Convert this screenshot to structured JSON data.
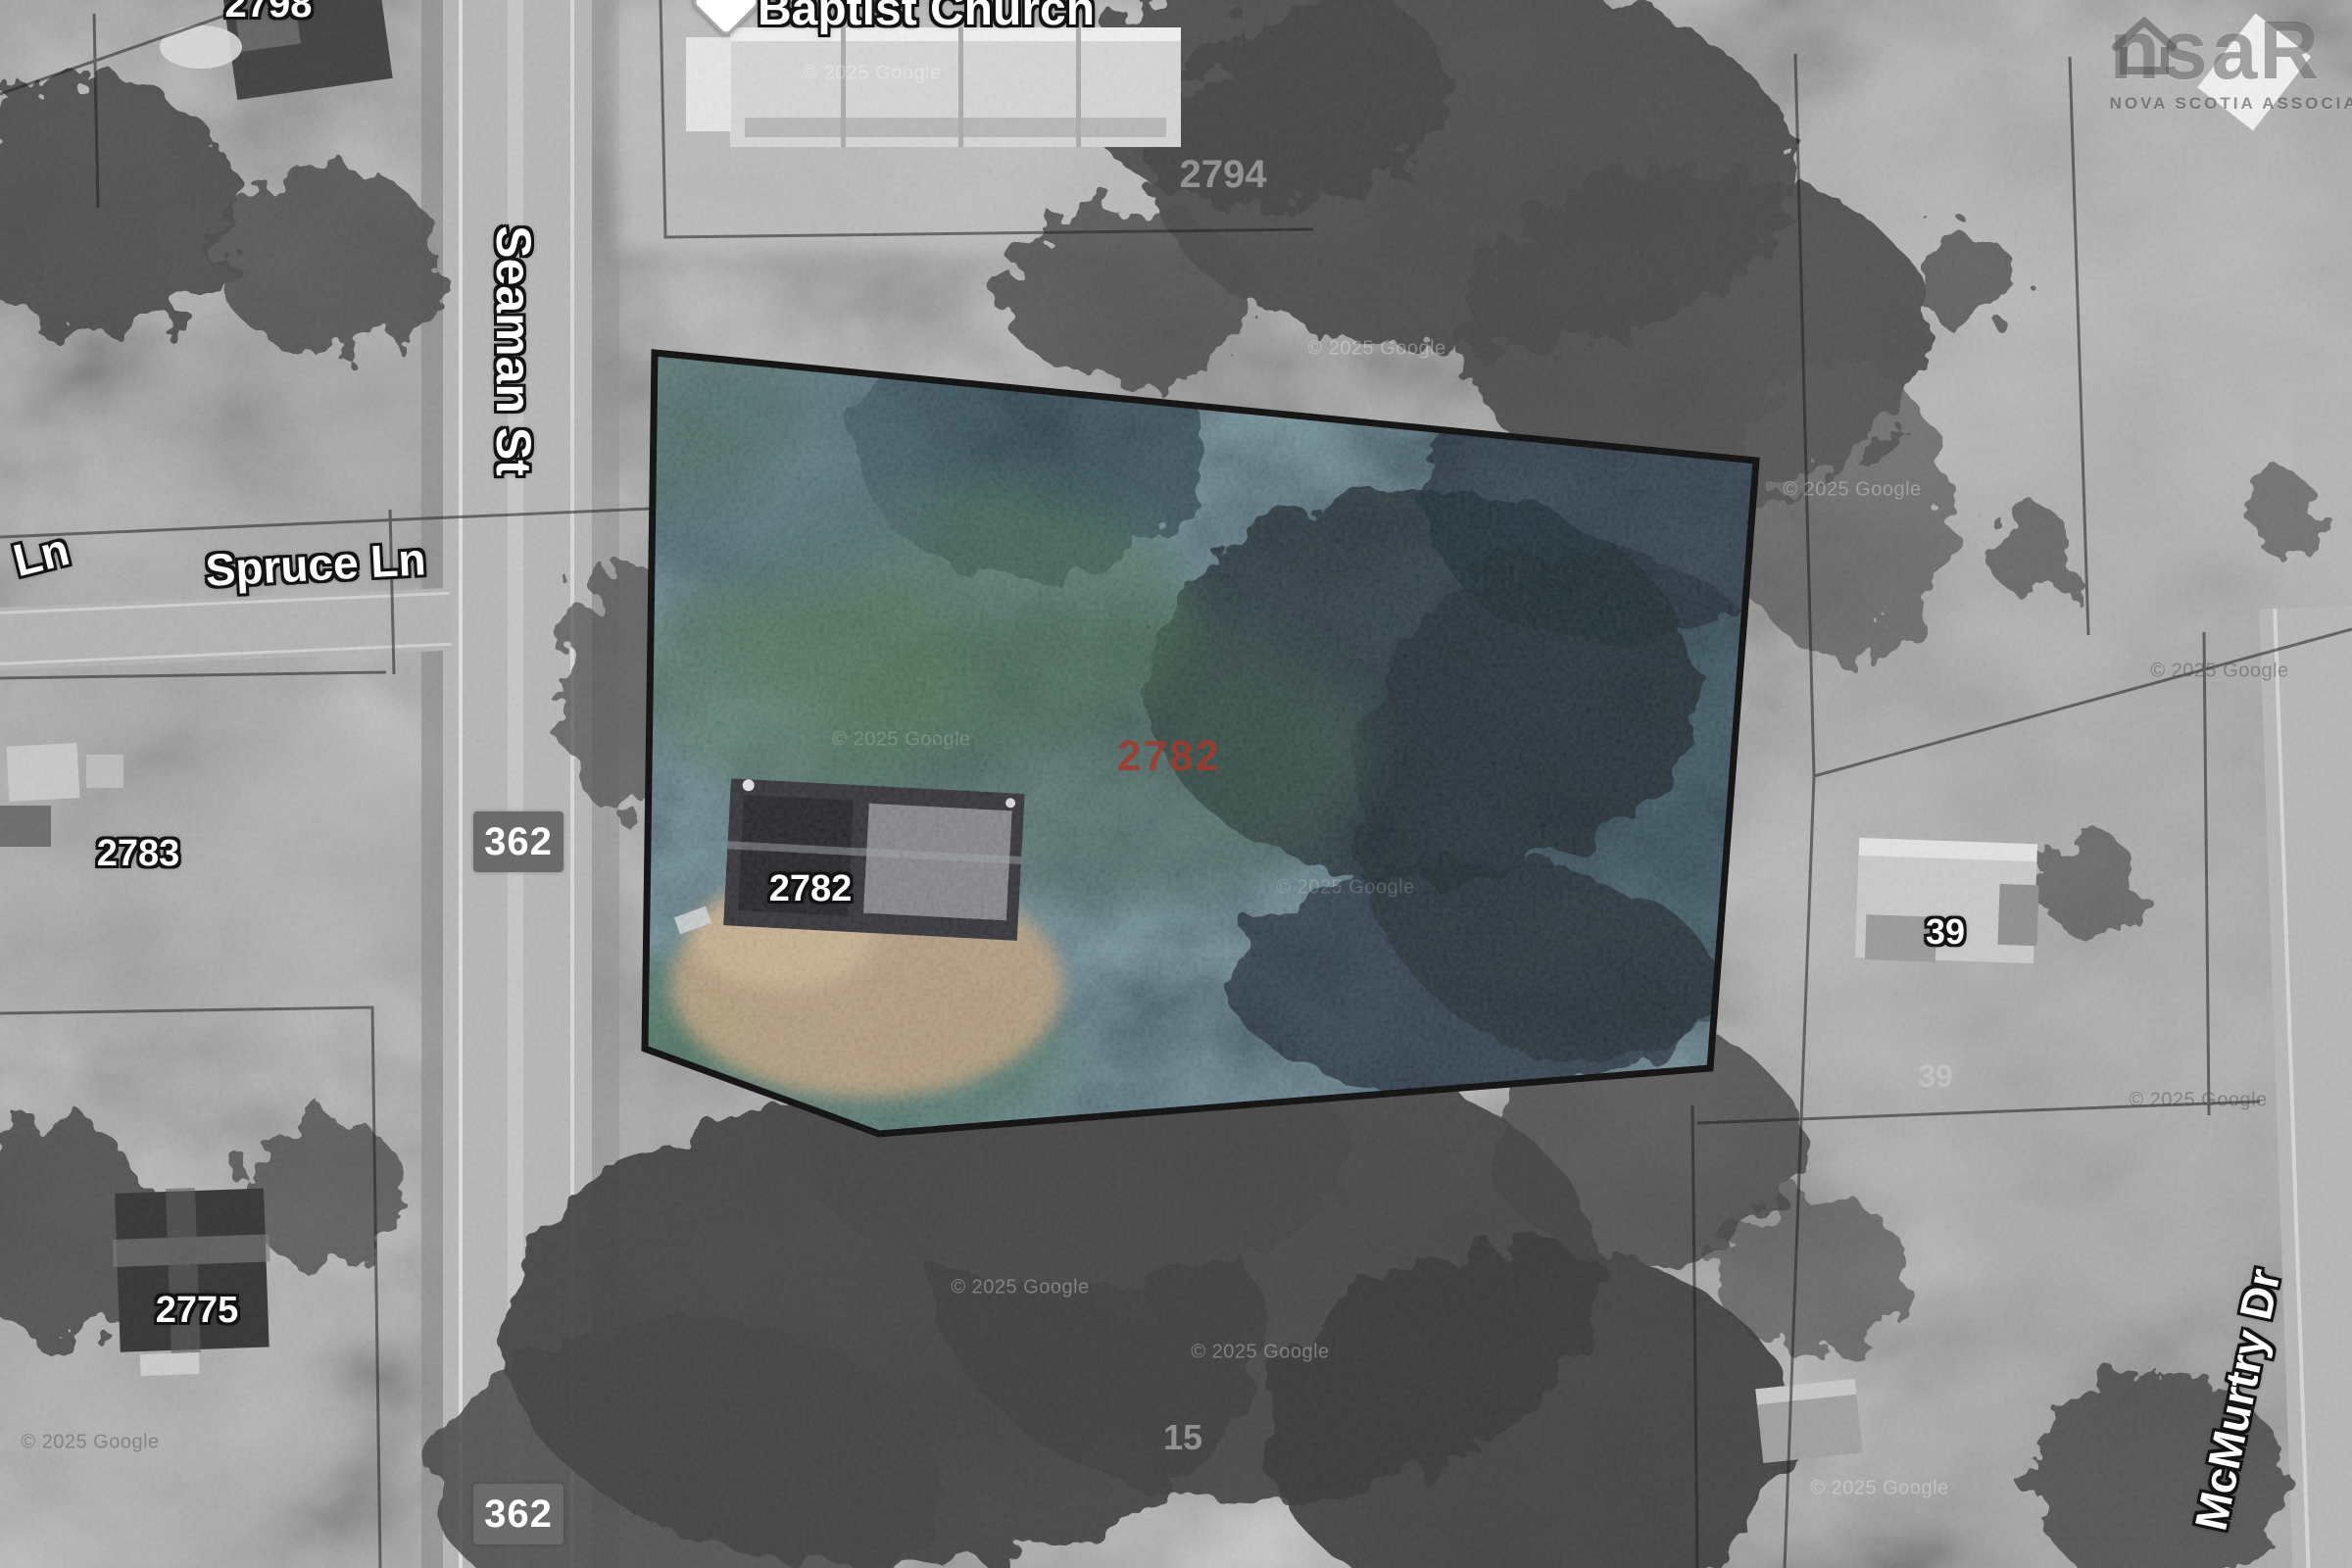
{
  "map": {
    "attribution": "© 2025 Google",
    "poi_baptist_church": "Baptist Church",
    "street_seaman": "Seaman St",
    "street_spruce": "Spruce Ln",
    "street_ln_partial": "Ln",
    "street_mcmurtry": "McMurtry Dr",
    "route_shield": "362",
    "parcel_number": "2782",
    "parcel_number_color": "#a23a2e",
    "parcel_outline_color": "#0a0a0a",
    "house_2798": "2798",
    "house_2783": "2783",
    "house_2775": "2775",
    "house_2782": "2782",
    "house_39": "39",
    "lot_2794": "2794",
    "lot_39": "39",
    "lot_15": "15",
    "branding_prefix": "ns",
    "branding_suffix": "aR",
    "branding_subtext": "NOVA SCOTIA ASSOCIATION"
  }
}
